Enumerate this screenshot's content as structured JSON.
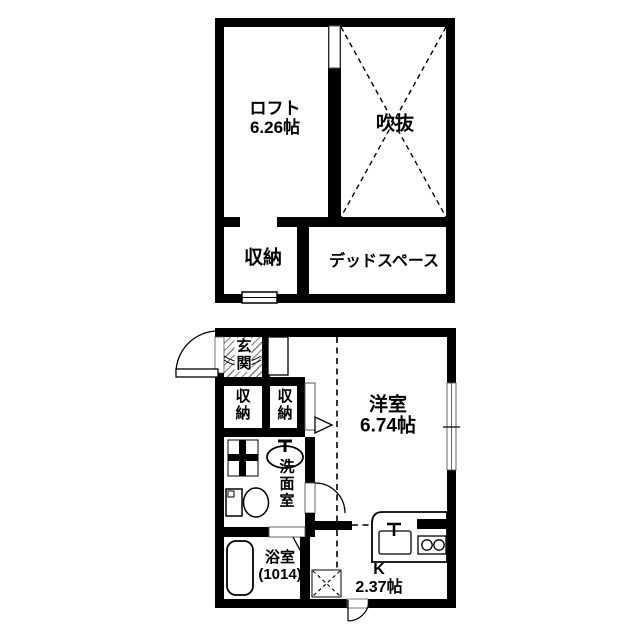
{
  "upper_floor": {
    "loft": {
      "label": "ロフト",
      "size": "6.26帖"
    },
    "void": {
      "label": "吹抜"
    },
    "storage": {
      "label": "収納"
    },
    "dead_space": {
      "label": "デッドスペース"
    }
  },
  "lower_floor": {
    "entrance": {
      "label": "玄関"
    },
    "storage_left": {
      "label": "収納"
    },
    "storage_mid": {
      "label": "収納"
    },
    "western_room": {
      "label": "洋室",
      "size": "6.74帖"
    },
    "washroom": {
      "label": "洗面室"
    },
    "bathroom": {
      "label": "浴室",
      "size": "(1014)"
    },
    "kitchen": {
      "label": "K",
      "size": "2.37帖"
    }
  },
  "fixtures": [
    "entrance-door-arc",
    "bathtub",
    "toilet",
    "washbasin",
    "kitchen-counter",
    "kitchen-sink",
    "stove-burners",
    "void-x-mark",
    "shaft-x-box",
    "window",
    "closet-door-triangle",
    "bath-door-v-mark",
    "cross-pane-window"
  ],
  "colors": {
    "wall": "#000000",
    "background": "#ffffff",
    "hatch": "#555555"
  }
}
